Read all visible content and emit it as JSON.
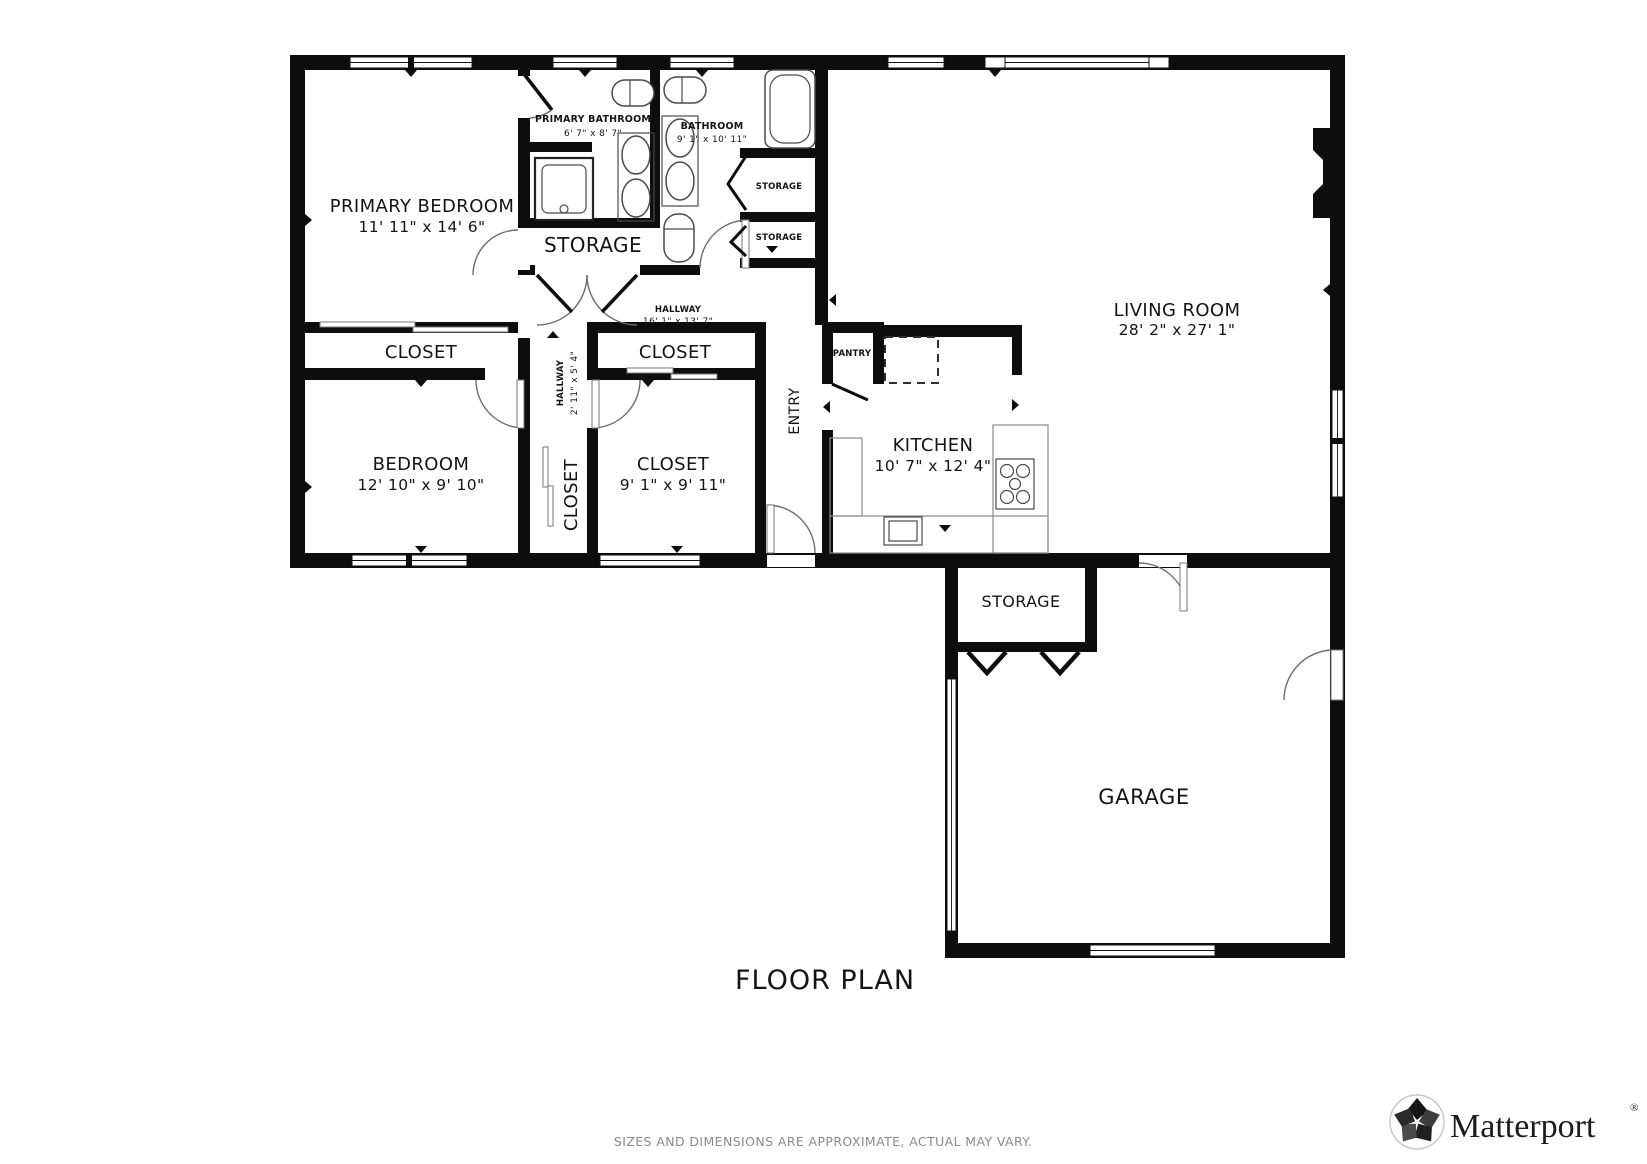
{
  "title": "FLOOR PLAN",
  "disclaimer": "SIZES AND DIMENSIONS ARE APPROXIMATE, ACTUAL MAY VARY.",
  "brand": {
    "name": "Matterport",
    "registered": "®"
  },
  "rooms": {
    "primary_bedroom": {
      "name": "PRIMARY BEDROOM",
      "dims": "11' 11\" x 14' 6\""
    },
    "primary_bathroom": {
      "name": "PRIMARY BATHROOM",
      "dims": "6' 7\" x 8' 7\""
    },
    "bathroom": {
      "name": "BATHROOM",
      "dims": "9' 1\" x 10' 11\""
    },
    "storage_hall": {
      "name": "STORAGE"
    },
    "storage_small_top": {
      "name": "STORAGE"
    },
    "storage_small_bottom": {
      "name": "STORAGE"
    },
    "hallway_main": {
      "name": "HALLWAY",
      "dims": "16' 1\" x 13' 7\""
    },
    "closet_west": {
      "name": "CLOSET"
    },
    "bedroom": {
      "name": "BEDROOM",
      "dims": "12' 10\" x 9' 10\""
    },
    "hallway_west": {
      "name": "HALLWAY",
      "dims": "2' 11\" x 5' 4\""
    },
    "closet_vertical": {
      "name": "CLOSET"
    },
    "closet_center": {
      "name": "CLOSET"
    },
    "closet_room": {
      "name": "CLOSET",
      "dims": "9' 1\" x 9' 11\""
    },
    "entry": {
      "name": "ENTRY"
    },
    "pantry": {
      "name": "PANTRY"
    },
    "kitchen": {
      "name": "KITCHEN",
      "dims": "10' 7\" x 12' 4\""
    },
    "living_room": {
      "name": "LIVING ROOM",
      "dims": "28' 2\" x 27' 1\""
    },
    "storage_garage": {
      "name": "STORAGE"
    },
    "garage": {
      "name": "GARAGE"
    }
  }
}
